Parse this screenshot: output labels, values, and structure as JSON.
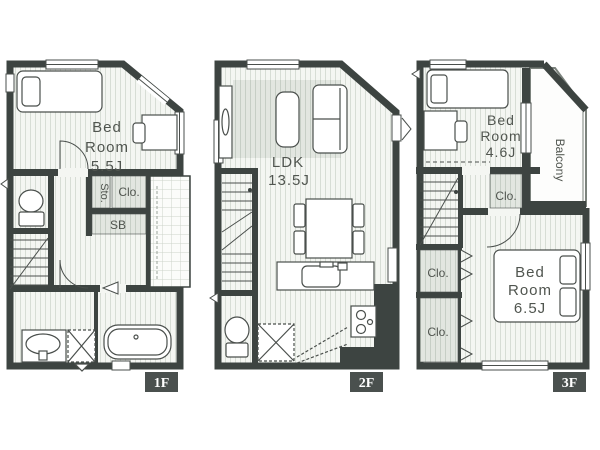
{
  "title": "3-story house floor plan",
  "colors": {
    "wall": "#3d4441",
    "floor_bg": "#f4f6f2",
    "floor_stripe": "#d7ddd5",
    "shade_bg": "#e2e6e0",
    "shade_stripe": "#c6cec5",
    "tile_bg": "#fbfcfa",
    "tile_line": "#ccd3ca",
    "tag_bg": "#4a504e",
    "tag_text": "#ffffff",
    "label_text": "#50554f",
    "line": "#4a4f4c",
    "background": "#ffffff"
  },
  "floors": [
    {
      "tag": "1F",
      "labels": {
        "bedroom": [
          "Bed",
          "Room",
          "5.5J"
        ],
        "storage": "Sto.",
        "closet": "Clo.",
        "shoebox": "SB"
      }
    },
    {
      "tag": "2F",
      "labels": {
        "ldk": [
          "LDK",
          "13.5J"
        ]
      }
    },
    {
      "tag": "3F",
      "labels": {
        "bedroom_small": [
          "Bed",
          "Room",
          "4.6J"
        ],
        "balcony": "Balcony",
        "closet_upper": "Clo.",
        "closet_mid": "Clo.",
        "closet_lower": "Clo.",
        "bedroom_main": [
          "Bed",
          "Room",
          "6.5J"
        ]
      }
    }
  ]
}
